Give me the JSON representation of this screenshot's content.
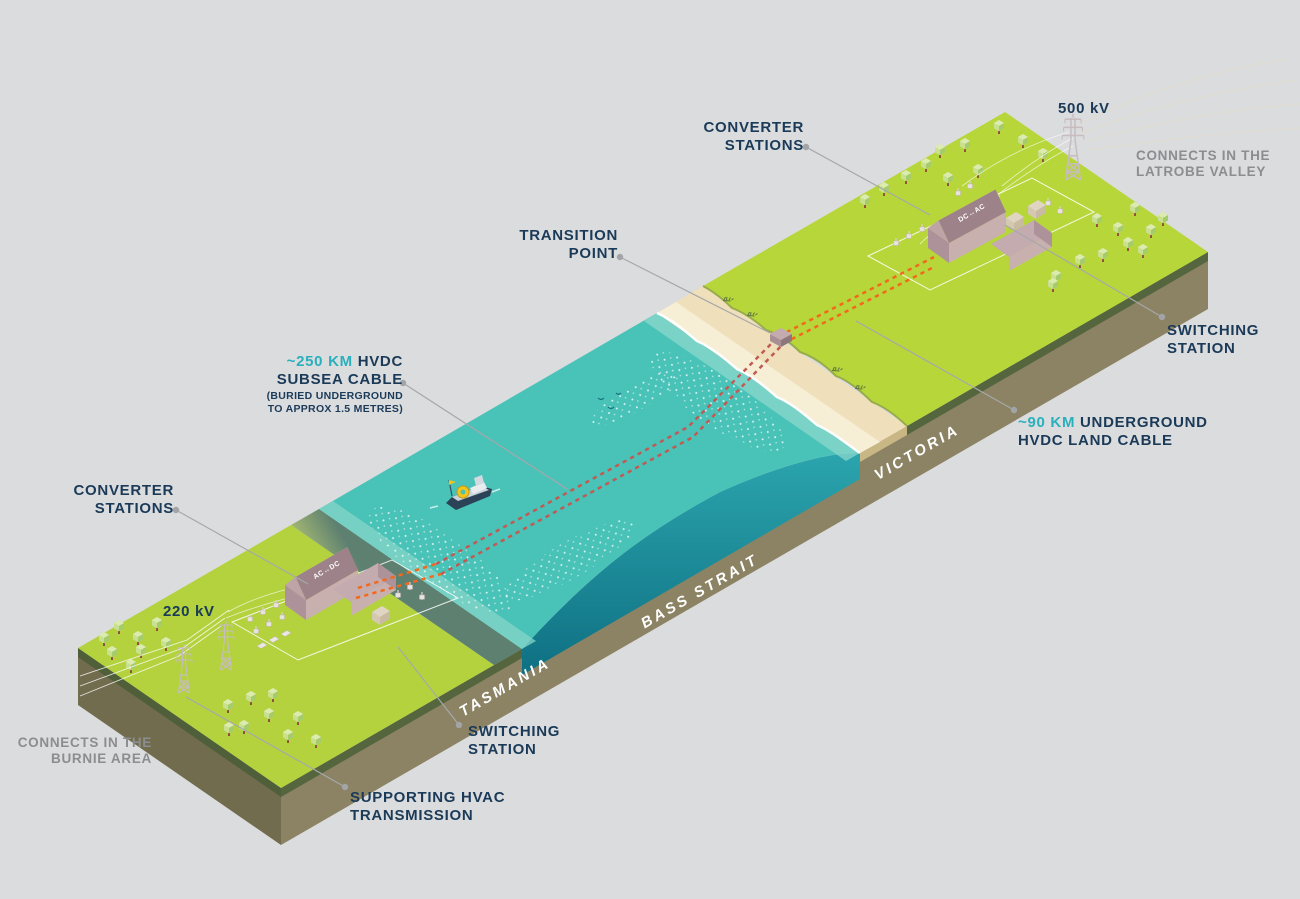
{
  "colors": {
    "background": "#DBDCDE",
    "navy_text": "#1A3A58",
    "teal_accent_text": "#29B0BC",
    "gray_text": "#8B8D90",
    "land_green": "#B5D43C",
    "water_teal": "#49C2B8",
    "earth_olive": "#8B8363",
    "beach_sand": "#EFDFBA",
    "cable_orange": "#F2691E",
    "cable_subsea_red": "#C05B54"
  },
  "labels": {
    "converter_top_1": "CONVERTER",
    "converter_top_2": "STATIONS",
    "kv500": "500 kV",
    "latrobe_1": "CONNECTS IN THE",
    "latrobe_2": "LATROBE VALLEY",
    "transition_1": "TRANSITION",
    "transition_2": "POINT",
    "switching_r_1": "SWITCHING",
    "switching_r_2": "STATION",
    "subsea_accent": "~250 KM",
    "subsea_1b": " HVDC",
    "subsea_2": "SUBSEA CABLE",
    "subsea_note_1": "(BURIED UNDERGROUND",
    "subsea_note_2": "TO APPROX 1.5 METRES)",
    "landcable_accent": "~90 KM",
    "landcable_1b": " UNDERGROUND",
    "landcable_2": "HVDC LAND CABLE",
    "converter_left_1": "CONVERTER",
    "converter_left_2": "STATIONS",
    "kv220": "220 kV",
    "burnie_1": "CONNECTS IN THE",
    "burnie_2": "BURNIE AREA",
    "switching_b_1": "SWITCHING",
    "switching_b_2": "STATION",
    "hvac_1": "SUPPORTING HVAC",
    "hvac_2": "TRANSMISSION"
  },
  "regions": {
    "tasmania": "TASMANIA",
    "bass_strait": "BASS STRAIT",
    "victoria": "VICTORIA"
  },
  "buildings": {
    "tas": "AC↔DC",
    "vic": "DC↔AC"
  }
}
